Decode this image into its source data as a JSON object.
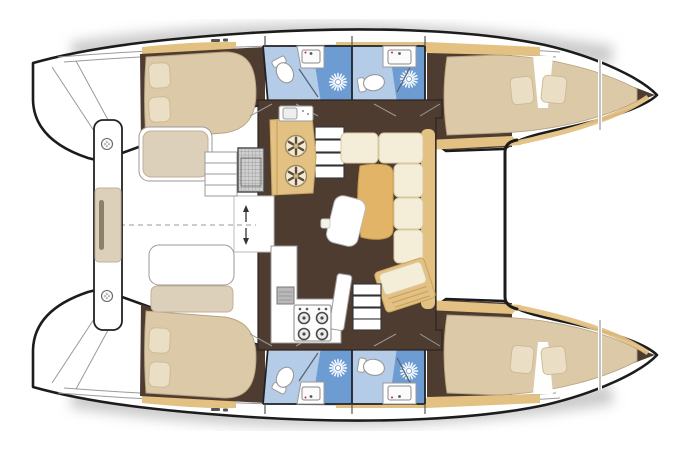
{
  "title": "Catamaran interior layout floor plan (4 cabins, 4 heads)",
  "colors": {
    "hull_fill": "#ffffff",
    "outline": "#1c1c1c",
    "floor": "#4e3c31",
    "wood": "#e3c183",
    "wood_dark": "#c9a35f",
    "bed": "#dcc9a8",
    "pillow": "#eadec4",
    "cushion": "#f4edd8",
    "cushion_trim": "#d9c9a0",
    "table": "#e2b468",
    "tile_light": "#b5cce8",
    "tile_dark": "#6d9cd3",
    "bench": "#ddd0ba",
    "line_gray": "#9a9a9a",
    "shadow": "#cbcbcb",
    "accent_red": "#b33131"
  },
  "layout": {
    "port_hull": {
      "aft_cabin": "double-berth-with-two-pillows",
      "heads": [
        "aft-head-toilet-sink-shower",
        "forward-head-toilet-sink-shower"
      ],
      "forward_cabin": "double-berth-with-two-pillows"
    },
    "starboard_hull": {
      "aft_cabin": "double-berth-with-two-pillows",
      "heads": [
        "aft-head-toilet-sink-shower",
        "forward-head-toilet-sink-shower"
      ],
      "forward_cabin": "double-berth-with-two-pillows"
    },
    "saloon": {
      "galley": [
        "refrigerator-cabinet",
        "sink",
        "four-burner-stove"
      ],
      "dinette": [
        "l-shaped-settee",
        "chaise-bench",
        "table",
        "stool"
      ],
      "stairs": [
        "port-companionway",
        "starboard-companionway"
      ],
      "entry": "aft-sliding-door-with-arrows"
    },
    "cockpit": [
      "port-bench",
      "starboard-bench",
      "entry-steps",
      "grating",
      "aft-beam-seat"
    ],
    "foredeck": "area-between-bows-forward-beam"
  },
  "icons": {
    "shower_head": "white-sunburst",
    "toilet": "oval-bowl-with-tank",
    "sink_basin": "rect-with-faucet-dot",
    "stove_burner": "ring-with-center-dot",
    "fridge_vent": "circle-with-six-spokes",
    "deck_hatch": "circle-with-dots",
    "door_arrows": "up-and-down-arrows"
  }
}
